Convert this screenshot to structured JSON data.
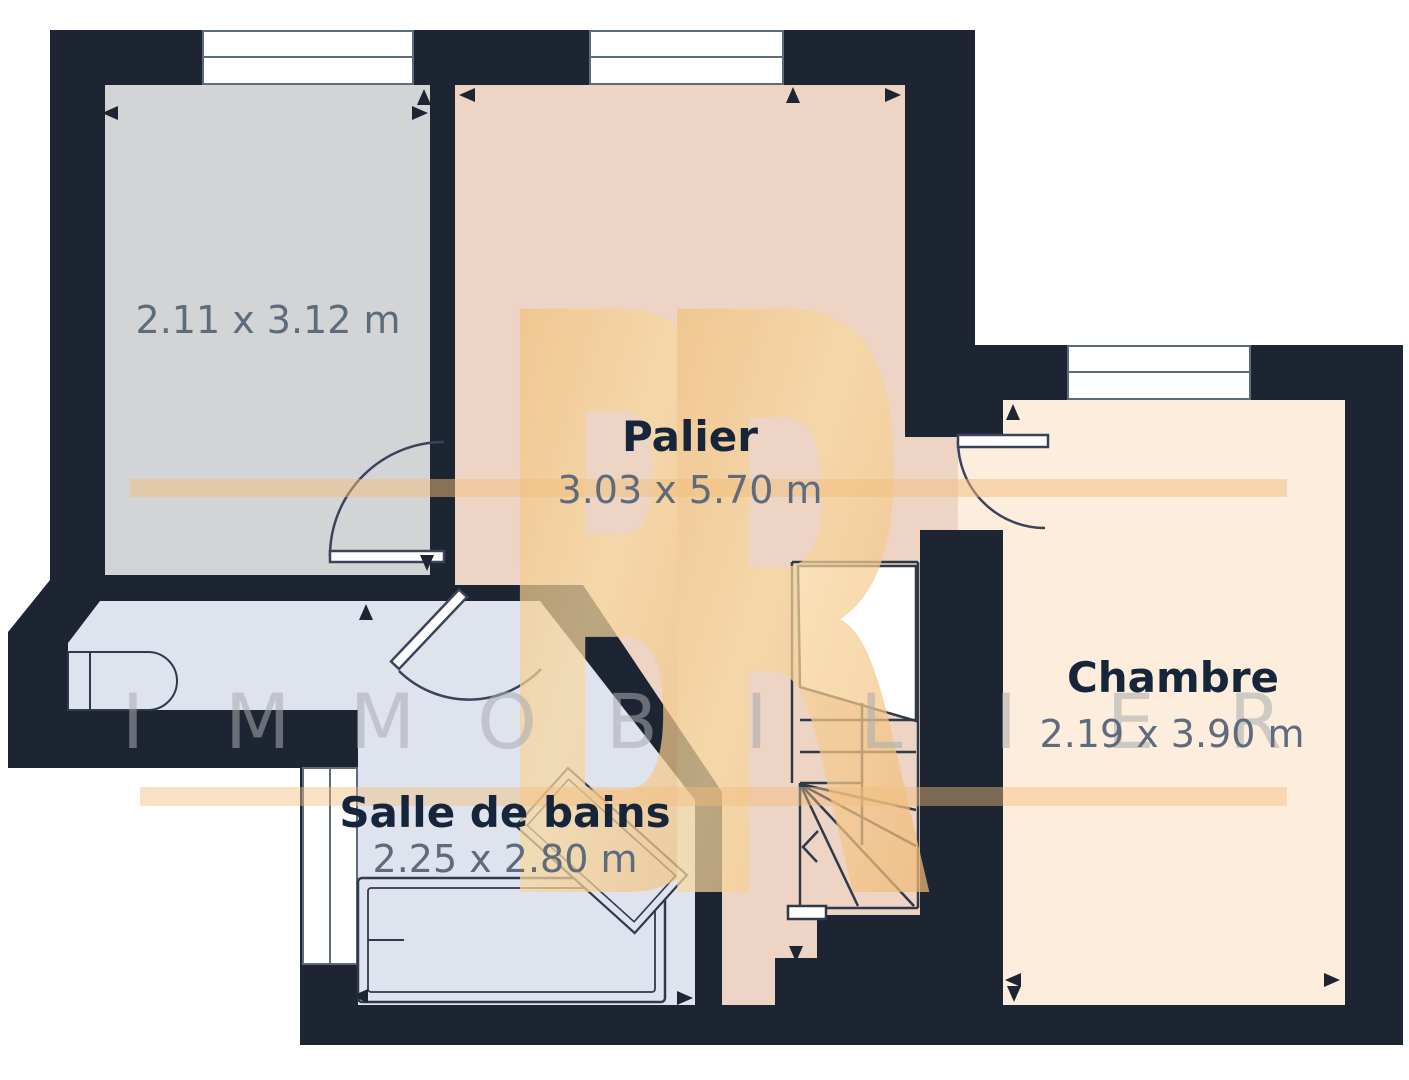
{
  "plan": {
    "title": "floor-plan",
    "rooms": [
      {
        "id": "room-top-left",
        "name": "",
        "dims": "2.11 x 3.12 m"
      },
      {
        "id": "palier",
        "name": "Palier",
        "dims": "3.03 x 5.70 m"
      },
      {
        "id": "chambre",
        "name": "Chambre",
        "dims": "2.19 x 3.90 m"
      },
      {
        "id": "salle-de-bains",
        "name": "Salle de bains",
        "dims": "2.25 x 2.80 m"
      }
    ],
    "features": [
      "staircase",
      "bathtub",
      "windows",
      "door-swings",
      "dimension-arrows"
    ]
  },
  "watermark": {
    "monogram": "BR",
    "word": "IMMOBILIER"
  },
  "colors": {
    "wall": "#1d2533",
    "room_top_left_fill": "#d3d4d6",
    "palier_fill": "#edd4c4",
    "chambre_fill": "#fdeddc",
    "bathroom_fill": "#dfe3ee",
    "line": "#39445a",
    "window_line": "#5d6b7c",
    "room_name_text": "#17253b",
    "dimension_text": "#5d6b7c",
    "watermark_gold": "#f2bd7c",
    "watermark_gold_light": "#f9dda6",
    "watermark_gray": "#a9acb0"
  }
}
